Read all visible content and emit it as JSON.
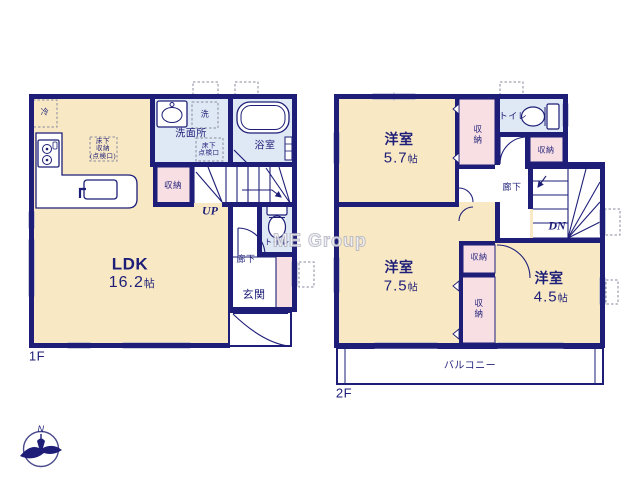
{
  "watermark": "ME Group",
  "floor1": {
    "label": "1F",
    "ldk": {
      "name": "LDK",
      "size": "16.2",
      "unit": "帖"
    },
    "washroom": "洗面所",
    "bathroom": "浴室",
    "toilet": "トイレ",
    "hallway": "廊下",
    "entrance": "玄関",
    "storage": "収納",
    "stairs": "UP",
    "fridge": "冷",
    "washer": "洗",
    "underfloor_storage": "床下\n収納\n(点検口)",
    "underfloor_hatch": "床下\n点検口"
  },
  "floor2": {
    "label": "2F",
    "bedroom_a": {
      "name": "洋室",
      "size": "5.7",
      "unit": "帖"
    },
    "bedroom_b": {
      "name": "洋室",
      "size": "7.5",
      "unit": "帖"
    },
    "bedroom_c": {
      "name": "洋室",
      "size": "4.5",
      "unit": "帖"
    },
    "toilet": "トイレ",
    "hallway": "廊下",
    "storage": "収納",
    "balcony": "バルコニー",
    "stairs": "DN"
  },
  "compass": {
    "north": "N"
  },
  "colors": {
    "wall": "#1e1e78",
    "room_cream": "#f8e9c4",
    "wet_blue": "#dfe9f5",
    "storage_pink": "#f8dfe3",
    "window_gray": "#9aa0c5"
  }
}
